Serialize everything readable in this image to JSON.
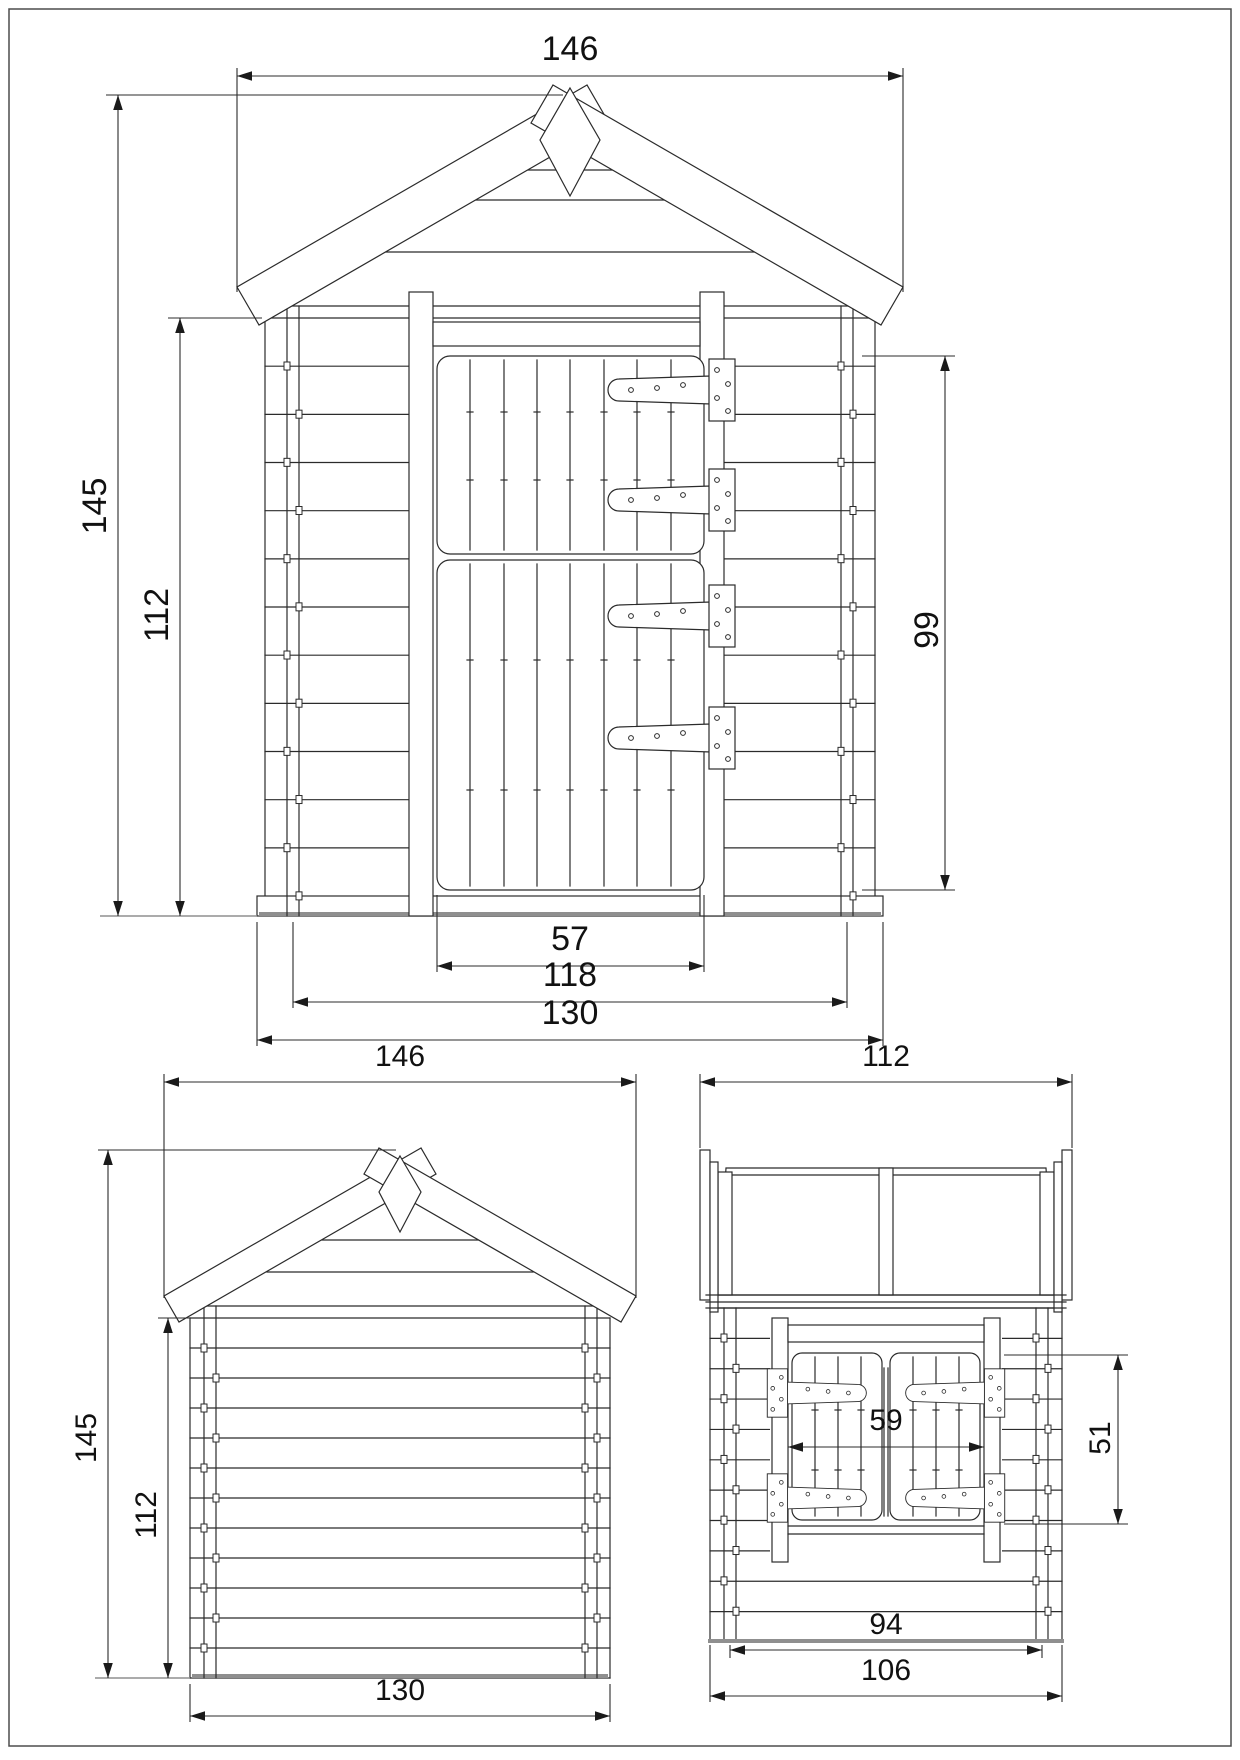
{
  "drawing": {
    "colors": {
      "line": "#2b2b2b",
      "ground_line": "#8f8f8f",
      "text": "#111111",
      "background": "#ffffff",
      "frame": "#4d4d4d"
    },
    "views": {
      "front": {
        "dims": {
          "roof_width": "146",
          "total_height": "145",
          "wall_height": "112",
          "door_height": "99",
          "door_width": "57",
          "frame_width": "118",
          "base_width": "130"
        }
      },
      "back": {
        "dims": {
          "roof_width": "146",
          "total_height": "145",
          "wall_height": "112",
          "base_width": "130"
        }
      },
      "side": {
        "dims": {
          "depth": "112",
          "window_width": "59",
          "window_height": "51",
          "inner_width": "94",
          "wall_depth": "106"
        }
      }
    }
  }
}
